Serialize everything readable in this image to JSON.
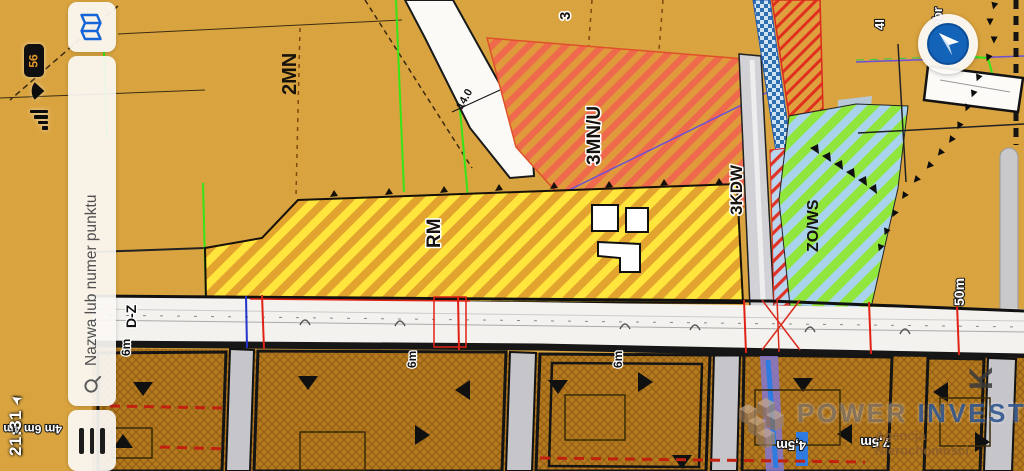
{
  "status": {
    "time": "21:31",
    "battery_percent": "56"
  },
  "search": {
    "placeholder": "Nazwa lub numer punktu"
  },
  "icons": {
    "map_button": "map-icon",
    "search": "search-icon",
    "menu": "menu-icon",
    "compass": "compass-icon",
    "location": "location-arrow-icon",
    "battery": "battery-icon",
    "wifi": "wifi-icon",
    "signal": "signal-bars-icon"
  },
  "watermark": {
    "brand_part1": "POWER",
    "brand_part2": " INVEST",
    "subtitle": "Agencja Nieruchomości"
  },
  "colors": {
    "accent_blue": "#1565D8",
    "map_orange": "#D9A440",
    "zone_red_hatch": "#EF6A4C",
    "zone_yellow": "#FFE53C",
    "zone_green": "#90E63C",
    "plots_brown": "#B57A20"
  },
  "map": {
    "labels": [
      {
        "t": "2MN",
        "x": 296,
        "y": 95,
        "s": 20,
        "cls": "zone"
      },
      {
        "t": "3MN/U",
        "x": 600,
        "y": 165,
        "s": 19,
        "cls": "zoneHalo"
      },
      {
        "t": "RM",
        "x": 440,
        "y": 248,
        "s": 19,
        "cls": "zoneHalo"
      },
      {
        "t": "3KDW",
        "x": 742,
        "y": 215,
        "s": 17,
        "cls": "zoneHalo"
      },
      {
        "t": "ZO/WS",
        "x": 818,
        "y": 252,
        "s": 16,
        "cls": "zone"
      },
      {
        "t": "3",
        "x": 570,
        "y": 20,
        "s": 15,
        "cls": "zoneHalo"
      },
      {
        "t": "D-Z",
        "x": 136,
        "y": 328,
        "s": 14,
        "cls": "roadlbl"
      },
      {
        "t": "6m",
        "x": 130,
        "y": 356,
        "s": 12,
        "cls": "roadlbl"
      },
      {
        "t": "6m",
        "x": 416,
        "y": 368,
        "s": 12,
        "cls": "roadlbl"
      },
      {
        "t": "6m",
        "x": 622,
        "y": 368,
        "s": 12,
        "cls": "roadlbl"
      },
      {
        "t": "50m",
        "x": 964,
        "y": 306,
        "s": 14,
        "cls": "whiteLbl"
      },
      {
        "t": "4I",
        "x": 884,
        "y": 30,
        "s": 13,
        "cls": "whiteLbl"
      },
      {
        "t": "obr",
        "x": 942,
        "y": 28,
        "s": 13,
        "cls": "whiteLbl"
      },
      {
        "t": "K",
        "x": 992,
        "y": 390,
        "s": 32,
        "cls": "grayLbl"
      },
      {
        "t": "14.0",
        "x": 462,
        "y": 110,
        "s": 11,
        "cls": "thin",
        "rot": -60
      },
      {
        "t": "4m 6m 4m",
        "x": 62,
        "y": 425,
        "s": 12,
        "cls": "whiteLbl",
        "rot": 180
      },
      {
        "t": "4,5m",
        "x": 806,
        "y": 441,
        "s": 13,
        "cls": "whiteLbl",
        "rot": 180
      },
      {
        "t": "7,5m",
        "x": 890,
        "y": 438,
        "s": 13,
        "cls": "whiteLbl",
        "rot": 180
      }
    ]
  }
}
